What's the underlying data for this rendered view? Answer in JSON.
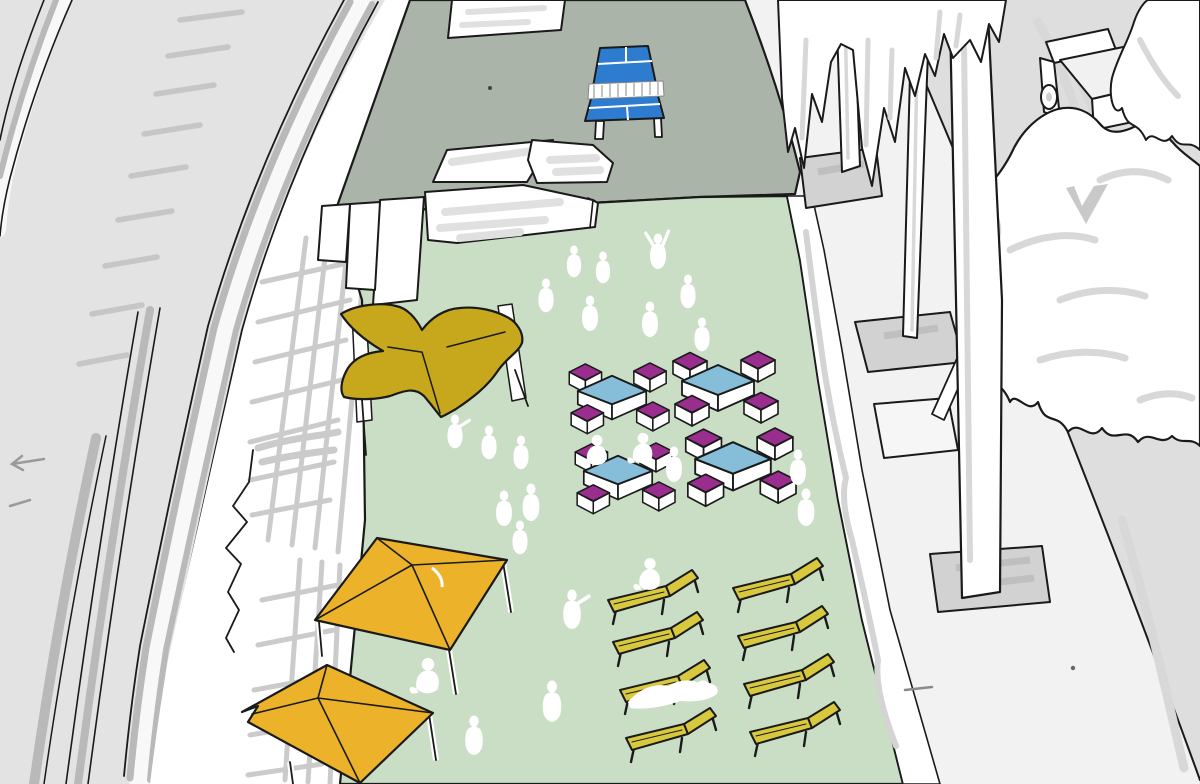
{
  "palette": {
    "outline": "#1a1a1a",
    "track_bed": "#e3e3e3",
    "rail_gray": "#b9b9b9",
    "rail_white": "#f8f8f8",
    "sleeper_gray": "#c6c6c6",
    "platform_white": "#ffffff",
    "trellis_gray": "#cbcbcb",
    "pavement_sage": "#aab4a8",
    "plaza_green": "#c9dec4",
    "sidewalk": "#f2f2f2",
    "road": "#dedede",
    "pingpong_blue": "#2e7cd0",
    "table_blue": "#86bdd8",
    "stool_purple": "#992e8e",
    "canopy_mustard": "#c7a81c",
    "umbrella_yellow": "#ecb32a",
    "lounger_yellow": "#d8c83e",
    "people_white": "#ffffff",
    "bench_shade": "#e0e0e0",
    "planter_gray": "#d2d2d2",
    "palm_gray": "#d8d8d8"
  },
  "scene": {
    "object_counts": {
      "ping_pong_table": 1,
      "cafe_table_sets": 4,
      "stools_per_set": 4,
      "shade_umbrellas": 2,
      "butterfly_canopy": 1,
      "sun_loungers": 8,
      "white_benches": 5,
      "palm_trees": 3,
      "tree_planters": 3,
      "empty_planter": 1,
      "truck": 1,
      "people": 25
    },
    "cafe_table_sets": [
      {
        "x": 612,
        "y": 391,
        "s": 0.95
      },
      {
        "x": 718,
        "y": 381,
        "s": 1
      },
      {
        "x": 618,
        "y": 471,
        "s": 0.95
      },
      {
        "x": 733,
        "y": 459,
        "s": 1.05
      }
    ],
    "loungers": [
      {
        "x": 608,
        "y": 580
      },
      {
        "x": 613,
        "y": 622
      },
      {
        "x": 620,
        "y": 670
      },
      {
        "x": 626,
        "y": 718
      },
      {
        "x": 733,
        "y": 568
      },
      {
        "x": 738,
        "y": 616
      },
      {
        "x": 744,
        "y": 664
      },
      {
        "x": 750,
        "y": 712
      }
    ],
    "people": [
      {
        "x": 546,
        "y": 296,
        "s": 0.9,
        "pose": "stand"
      },
      {
        "x": 574,
        "y": 262,
        "s": 0.85,
        "pose": "stand"
      },
      {
        "x": 603,
        "y": 268,
        "s": 0.85,
        "pose": "stand"
      },
      {
        "x": 590,
        "y": 314,
        "s": 0.95,
        "pose": "stand"
      },
      {
        "x": 658,
        "y": 252,
        "s": 0.95,
        "pose": "arms-up"
      },
      {
        "x": 650,
        "y": 320,
        "s": 0.95,
        "pose": "stand"
      },
      {
        "x": 688,
        "y": 292,
        "s": 0.9,
        "pose": "stand"
      },
      {
        "x": 702,
        "y": 335,
        "s": 0.9,
        "pose": "stand"
      },
      {
        "x": 455,
        "y": 432,
        "s": 0.9,
        "pose": "point"
      },
      {
        "x": 489,
        "y": 443,
        "s": 0.9,
        "pose": "stand"
      },
      {
        "x": 521,
        "y": 453,
        "s": 0.9,
        "pose": "stand"
      },
      {
        "x": 531,
        "y": 503,
        "s": 1,
        "pose": "stand"
      },
      {
        "x": 504,
        "y": 509,
        "s": 0.95,
        "pose": "stand"
      },
      {
        "x": 597,
        "y": 452,
        "s": 0.9,
        "pose": "sit"
      },
      {
        "x": 643,
        "y": 450,
        "s": 0.9,
        "pose": "sit"
      },
      {
        "x": 674,
        "y": 465,
        "s": 0.95,
        "pose": "stand"
      },
      {
        "x": 798,
        "y": 468,
        "s": 0.95,
        "pose": "stand"
      },
      {
        "x": 806,
        "y": 508,
        "s": 1,
        "pose": "stand"
      },
      {
        "x": 520,
        "y": 538,
        "s": 0.9,
        "pose": "stand"
      },
      {
        "x": 572,
        "y": 610,
        "s": 1.05,
        "pose": "point"
      },
      {
        "x": 650,
        "y": 576,
        "s": 0.95,
        "pose": "sit"
      },
      {
        "x": 428,
        "y": 678,
        "s": 1.05,
        "pose": "sit"
      },
      {
        "x": 552,
        "y": 702,
        "s": 1.1,
        "pose": "stand"
      },
      {
        "x": 474,
        "y": 736,
        "s": 1.05,
        "pose": "stand"
      }
    ]
  }
}
